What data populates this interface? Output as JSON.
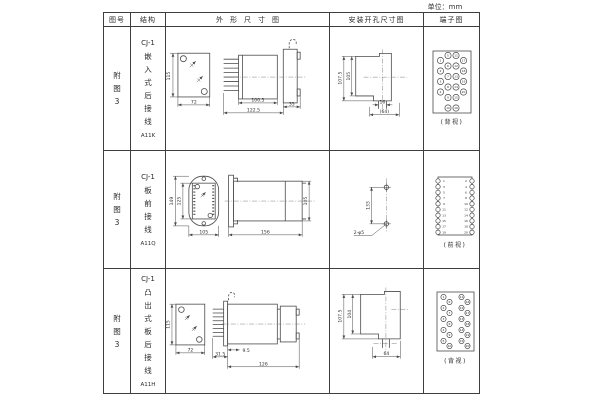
{
  "unit_label": "单位：mm",
  "table": {
    "headers": {
      "figure": "图号",
      "structure": "结构",
      "outline": "外形尺寸图",
      "install": "安装开孔尺寸图",
      "terminal": "端子图"
    },
    "rows": [
      {
        "figure_no": "附图3",
        "structure": {
          "model": "CJ-1",
          "mounting": "嵌入式后接线",
          "code": "A11K"
        },
        "outline": {
          "front_height": "115",
          "front_width": "72",
          "body_length": "100.5",
          "total_length": "122.5",
          "panel_width": "35"
        },
        "install": {
          "outer_height": "107.5",
          "inner_height": "105",
          "slot_width": "16",
          "span_width": "(64)"
        },
        "terminal": {
          "caption": "(背视)",
          "numbers": [
            1,
            2,
            3,
            4,
            5,
            6,
            7,
            8,
            9,
            10,
            11,
            12,
            13,
            14,
            15,
            16,
            17,
            18,
            19,
            20
          ]
        }
      },
      {
        "figure_no": "附图3",
        "structure": {
          "model": "CJ-1",
          "mounting": "板前接线",
          "code": "A11Q"
        },
        "outline": {
          "front_outer_height": "149",
          "front_inner_height": "125",
          "front_width": "105",
          "side_length": "156",
          "side_height": "105"
        },
        "install": {
          "hole_spacing": "133",
          "hole_label": "2-φ5"
        },
        "terminal": {
          "caption": "(前视)",
          "numbers": [
            1,
            3,
            5,
            7,
            9,
            11,
            13,
            15,
            17,
            19,
            2,
            4,
            6,
            8,
            10,
            12,
            14,
            16,
            18,
            20
          ]
        }
      },
      {
        "figure_no": "附图3",
        "structure": {
          "model": "CJ-1",
          "mounting": "凸出式板后接线",
          "code": "A11H"
        },
        "outline": {
          "front_height": "115",
          "front_width": "72",
          "pin_length": "31.5",
          "offset": "9.5",
          "body_length": "126"
        },
        "install": {
          "outer_height": "107.5",
          "inner_height": "104",
          "slot_width": "64"
        },
        "terminal": {
          "caption": "(背视)",
          "numbers": [
            1,
            2,
            3,
            4,
            5,
            6,
            7,
            8,
            9,
            10,
            11,
            12,
            13,
            14,
            15,
            16,
            17,
            18,
            19,
            20
          ]
        }
      }
    ]
  }
}
